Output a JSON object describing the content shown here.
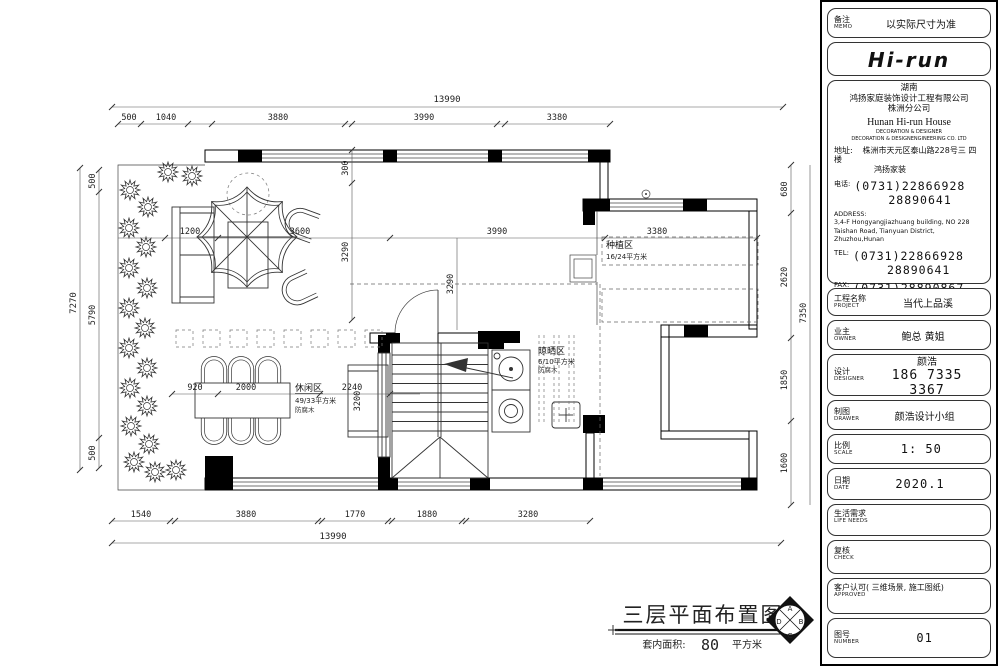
{
  "titleblock": {
    "memo": {
      "label": "备注",
      "en": "MEMO",
      "value": "以实际尺寸为准"
    },
    "logo": "Hi-run",
    "company": {
      "region": "湖南",
      "name": "鸿扬家庭装饰设计工程有限公司",
      "branch": "株洲分公司",
      "en_name": "Hunan  Hi-run  House",
      "en_sub1": "DECORATION & DESIGNER",
      "en_sub2": "DECORATION & DESIGNENGINEERING CO. LTD",
      "addr_label": "地址:",
      "addr1": "株洲市天元区泰山路228号三 四楼",
      "addr2": "鸿扬家装",
      "tel_cn_label": "电话:",
      "tel1": "(0731)22866928",
      "tel2": "28890641",
      "addr_en_label": "ADDRESS:",
      "addr_en": "3,4-F Hongyangjiazhuang building, NO 228 Taishan Road, Tianyuan District, Zhuzhou,Hunan",
      "tel_label": "TEL:",
      "fax_label": "FAX:",
      "fax": "(0731)28890867"
    },
    "project": {
      "label": "工程名称",
      "en": "PROJECT",
      "value": "当代上品溪"
    },
    "owner": {
      "label": "业主",
      "en": "OWNER",
      "value": "鲍总 黄姐"
    },
    "designer": {
      "label": "设计",
      "en": "DESIGNER",
      "value": "颜浩",
      "phone": "186 7335 3367"
    },
    "drawer": {
      "label": "制图",
      "en": "DRAWER",
      "value": "颜浩设计小组"
    },
    "scale": {
      "label": "比例",
      "en": "SCALE",
      "value": "1: 50"
    },
    "date": {
      "label": "日期",
      "en": "DATE",
      "value": "2020.1"
    },
    "life": {
      "label": "生活需求",
      "en": "LIFE  NEEDS"
    },
    "check": {
      "label": "复核",
      "en": "CHECK"
    },
    "approved": {
      "label": "客户认可( 三维场景, 施工图纸)",
      "en": "APPROVED"
    },
    "number": {
      "label": "图号",
      "en": "NUMBER",
      "value": "01"
    }
  },
  "drawing_title": {
    "main": "三层平面布置图",
    "sub_label": "套内面积:",
    "sub_value": "80",
    "sub_unit": "平方米",
    "compass": {
      "top": "A",
      "left": "D",
      "right": "B",
      "bottom": "C"
    }
  },
  "zones": {
    "planting": {
      "name": "种植区",
      "size": "16/24平方米"
    },
    "leisure": {
      "name": "休闲区",
      "size": "49/33平方米",
      "note": "防腐木"
    },
    "drying": {
      "name": "晾晒区",
      "size": "6/10平方米",
      "note": "防腐木"
    }
  },
  "dims": {
    "top_total": "13990",
    "top": [
      "500",
      "1040",
      "3880",
      "3990",
      "3380"
    ],
    "bottom": [
      "1540",
      "3880",
      "1770",
      "1880",
      "3280"
    ],
    "bottom_total": "13990",
    "left_total": "7270",
    "left": [
      "500",
      "5790",
      "500"
    ],
    "right": [
      "680",
      "2620",
      "1850",
      "1600"
    ],
    "right_total": "7350",
    "inner_h": [
      "1200",
      "3600",
      "3990",
      "3380"
    ],
    "inner_v": [
      "300",
      "3290"
    ],
    "inner_v2": "3290",
    "table_row": [
      "920",
      "2000",
      "2240"
    ],
    "bench": "3200"
  }
}
